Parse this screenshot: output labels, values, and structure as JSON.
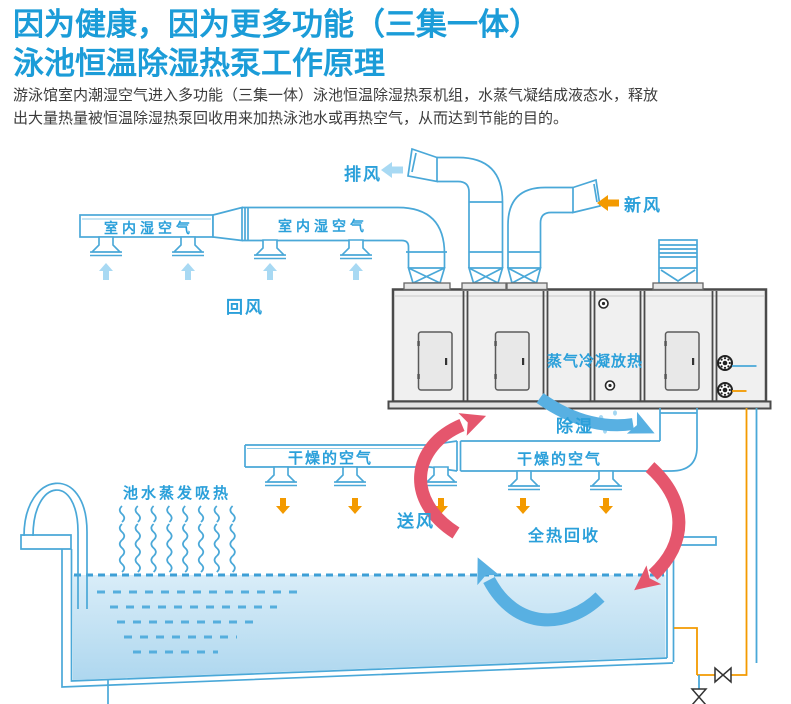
{
  "page": {
    "title_line1": "因为健康，因为更多功能（三集一体）",
    "title_line2": "泳池恒温除湿热泵工作原理",
    "intro_line1": "游泳馆室内潮湿空气进入多功能（三集一体）泳池恒温除湿热泵机组，水蒸气凝结成液态水，释放",
    "intro_line2": "出大量热量被恒温除湿热泵回收用来加热泳池水或再热空气，从而达到节能的目的。"
  },
  "diagram": {
    "labels": {
      "exhaust_air": "排风",
      "fresh_air": "新风",
      "indoor_humid_air_1": "室内湿空气",
      "indoor_humid_air_2": "室内湿空气",
      "return_air": "回风",
      "steam_condensation": "蒸气冷凝放热",
      "dehumidify": "除湿",
      "dry_air_1": "干燥的空气",
      "dry_air_2": "干燥的空气",
      "supply_air": "送风",
      "total_heat_recovery": "全热回收",
      "pool_evaporation": "池水蒸发吸热"
    },
    "colors": {
      "title_blue": "#1b9cd8",
      "label_blue": "#2ba0da",
      "line_blue": "#4aa8d8",
      "orange": "#f39a00",
      "light_blue_arrow": "#a8d9f3",
      "red_arrow": "#e5566d",
      "blue_arrow": "#58b0e2",
      "machine_gray": "#f0f0f0"
    }
  }
}
